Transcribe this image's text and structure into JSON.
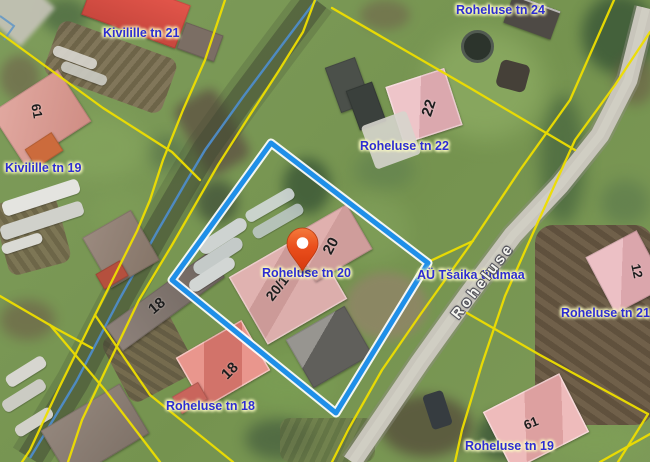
{
  "map": {
    "description": "Aerial cadastral map with highlighted parcel",
    "street_name_label": "Roheluse",
    "marker": {
      "type": "location-pin",
      "address": "Roheluse tn 20"
    },
    "highlighted_parcel": {
      "address": "Roheluse tn 20"
    },
    "address_labels": [
      {
        "text": "Kivilille tn 21"
      },
      {
        "text": "Roheluse tn 24"
      },
      {
        "text": "Kivilille tn 19"
      },
      {
        "text": "Roheluse tn 22"
      },
      {
        "text": "Roheluse tn 20"
      },
      {
        "text": "AÜ Tšaika üldmaa"
      },
      {
        "text": "Roheluse tn 21"
      },
      {
        "text": "Roheluse tn 18"
      },
      {
        "text": "Roheluse tn 19"
      }
    ],
    "building_numbers": [
      {
        "text": "61"
      },
      {
        "text": "18"
      },
      {
        "text": "18"
      },
      {
        "text": "20/1"
      },
      {
        "text": "20"
      },
      {
        "text": "22"
      },
      {
        "text": "12"
      },
      {
        "text": "61"
      }
    ],
    "colors": {
      "cadastral_line": "#eede00",
      "parcel_highlight": "#1f8fe8",
      "parcel_casing": "#ffffff",
      "marker": "#e84c1e",
      "address_label_text": "#2d2dd2",
      "address_label_halo": "#ffffc4",
      "street_label_text": "#f6f6f1",
      "road": "#c8c5bb",
      "stream": "#4e8cc8"
    }
  }
}
